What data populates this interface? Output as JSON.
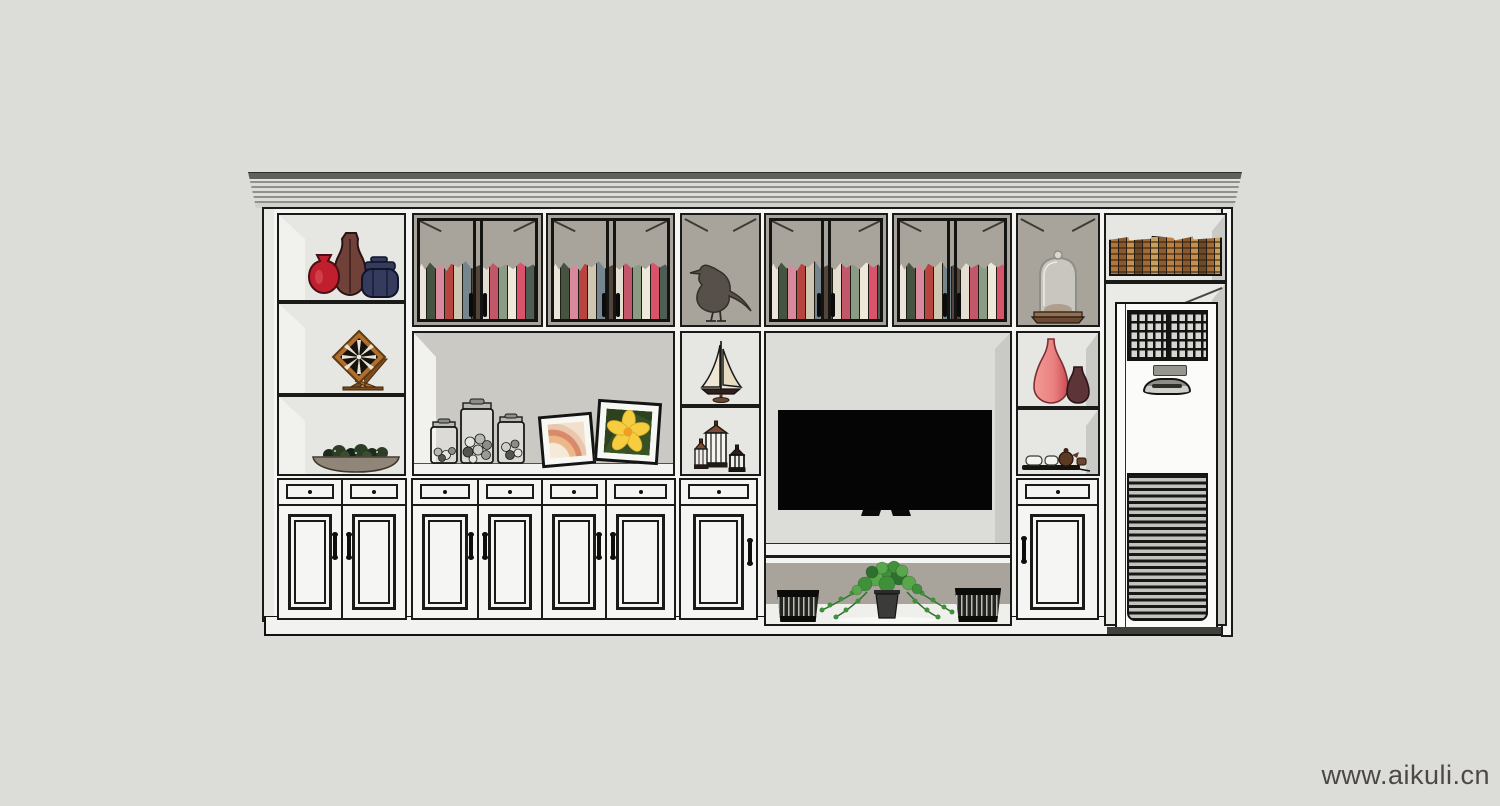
{
  "watermark": {
    "text": "www.aikuli.cn"
  },
  "colors": {
    "bg": "#dcdcd8",
    "line": "#1a1a19",
    "cab": "#f5f5f3",
    "cab-shade": "#e9e9e6",
    "cell-light": "#e6e6e3",
    "cell-taupe": "#a9a49b",
    "cell-mid": "#cbc9c4",
    "alcove": "#dcdcd8",
    "wall-hi": "#f1f1ee",
    "molding-dark": "#5f5f5d",
    "molding-mid": "#8f8f8b",
    "molding-light": "#dcdcd9",
    "tv": "#050505",
    "vase-red": "#c01f2e",
    "vase-maroon": "#6f4139",
    "jar-navy": "#343b5c",
    "clock-wood": "#b06f2e",
    "clock-wood-dark": "#7d4c1d",
    "bird": "#57504a",
    "sail": "#efe7d3",
    "hull": "#2e2018",
    "lantern": "#7c4b35",
    "shell": "#a8a8a3",
    "frame-black": "#141414",
    "leaf-dark": "#2c421f",
    "petal": "#f5cd3e",
    "vase-pink": "#e97f7f",
    "vase-plum": "#5d3438",
    "tray": "#15140f",
    "teapot": "#5d3a24",
    "cup": "#f4f3ef",
    "pot": "#3b3b39",
    "green1": "#3f8f3b",
    "green2": "#58a84b",
    "green3": "#2f7030",
    "basket": "#23231f",
    "ac-body": "#fbfbf9",
    "wood-base": "#6b4a34",
    "watermark": "#4c4944"
  },
  "books": {
    "glass_spines": [
      "#e9e5da",
      "#44543f",
      "#d8899b",
      "#b8433f",
      "#cfc6b2",
      "#76868f",
      "#54453a",
      "#e3decf",
      "#c2576a",
      "#8d9b84",
      "#efe9da",
      "#d9536a",
      "#4e5e55",
      "#ddd3c0",
      "#9b3f44",
      "#e7e2d4"
    ],
    "antique_spines": [
      "#b5763a",
      "#8a5a2e",
      "#c9904d",
      "#6e4a26",
      "#a36a33",
      "#caa05c",
      "#8f5c2c",
      "#bf8142"
    ]
  }
}
